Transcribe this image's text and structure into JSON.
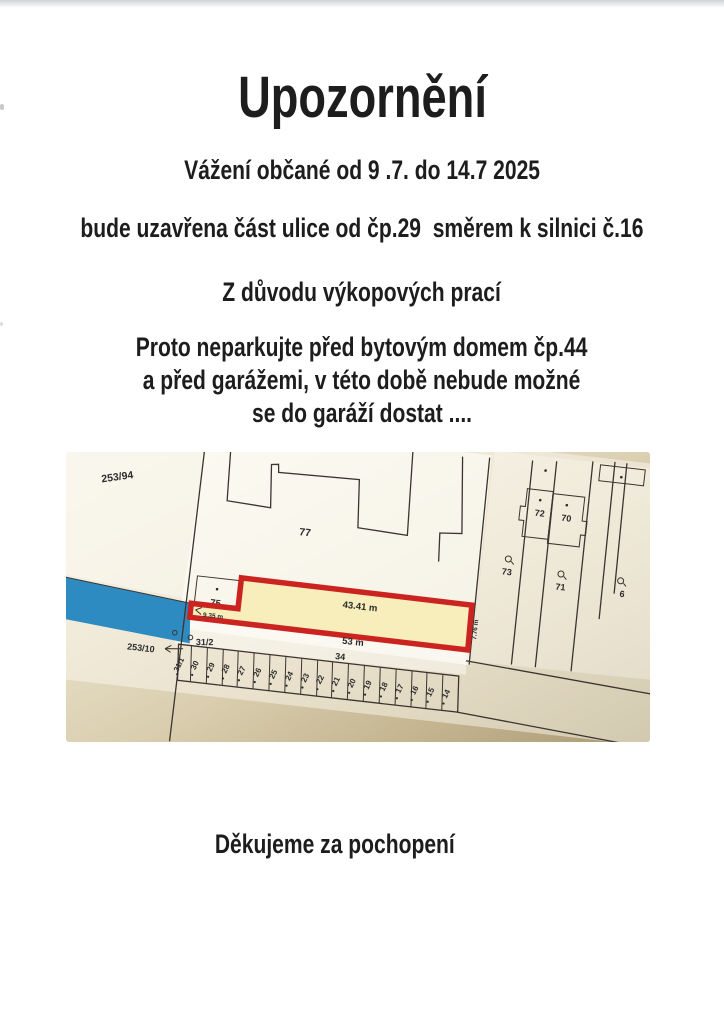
{
  "notice": {
    "title": "Upozornění",
    "line1": "Vážení občané od 9 .7. do 14.7 2025",
    "line2": "bude uzavřena část ulice od čp.29  směrem k silnici č.16",
    "line3": "Z důvodu výkopových prací",
    "para_line1": "Proto neparkujte před bytovým domem čp.44",
    "para_line2": "a před garážemi, v této době nebude možné",
    "para_line3": "se do garáží dostat ....",
    "thanks": "Děkujeme za pochopení"
  },
  "map": {
    "parcels": {
      "p253_94": "253/94",
      "p77": "77",
      "p75": "75",
      "p73": "73",
      "p72": "72",
      "p71": "71",
      "p70": "70",
      "p6x": "6",
      "p253_10": "253/10",
      "p31_2": "31/2",
      "p31_1": "31/1",
      "p34": "34"
    },
    "garages": [
      "30",
      "29",
      "28",
      "27",
      "26",
      "25",
      "24",
      "23",
      "22",
      "21",
      "20",
      "19",
      "18",
      "17",
      "16",
      "15",
      "14"
    ],
    "measurements": {
      "top": "43.41 m",
      "bottom": "53 m",
      "left": "9.35 m",
      "right": "7.76 m"
    },
    "colors": {
      "highlight_border": "#cb2420",
      "highlight_fill": "#f7eebb",
      "water": "#2e8bc2",
      "map_line": "#3b3430"
    }
  }
}
